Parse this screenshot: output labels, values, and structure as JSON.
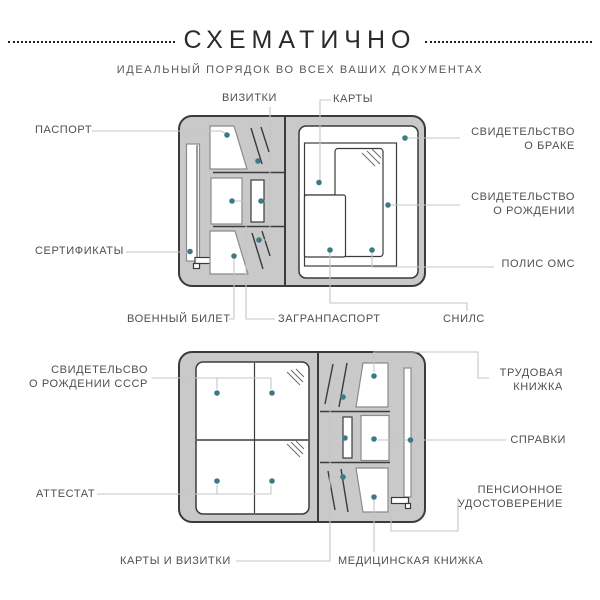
{
  "header": {
    "title": "СХЕМАТИЧНО",
    "subtitle": "ИДЕАЛЬНЫЙ ПОРЯДОК ВО ВСЕХ ВАШИХ ДОКУМЕНТАХ"
  },
  "colors": {
    "marker": "#3e7a86",
    "body_gray": "#c9c9c9",
    "outline_dark": "#3b3b3b",
    "leader_line": "#c5c5c5",
    "label_text": "#4f4f4f",
    "title_text": "#2a2a2a",
    "subtitle_text": "#585858"
  },
  "top_diagram": {
    "labels": {
      "passport": {
        "text": "ПАСПОРТ"
      },
      "business_cards": {
        "text": "ВИЗИТКИ"
      },
      "cards": {
        "text": "КАРТЫ"
      },
      "marriage_certificate": {
        "line1": "СВИДЕТЕЛЬСТВО",
        "line2": "О БРАКЕ"
      },
      "birth_certificate": {
        "line1": "СВИДЕТЕЛЬСТВО",
        "line2": "О РОЖДЕНИИ"
      },
      "oms_policy": {
        "text": "ПОЛИС ОМС"
      },
      "certificates": {
        "text": "СЕРТИФИКАТЫ"
      },
      "military_id": {
        "text": "ВОЕННЫЙ БИЛЕТ"
      },
      "international_passport": {
        "text": "ЗАГРАНПАСПОРТ"
      },
      "snils": {
        "text": "СНИЛС"
      }
    }
  },
  "bottom_diagram": {
    "labels": {
      "ussr_birth_certificate": {
        "line1": "СВИДЕТЕЛЬСВО",
        "line2": "О РОЖДЕНИИ СССР"
      },
      "attestat": {
        "text": "АТТЕСТАТ"
      },
      "work_record_book": {
        "line1": "ТРУДОВАЯ",
        "line2": "КНИЖКА"
      },
      "references": {
        "text": "СПРАВКИ"
      },
      "pension_certificate": {
        "line1": "ПЕНСИОННОЕ",
        "line2": "УДОСТОВЕРЕНИЕ"
      },
      "cards_and_business_cards": {
        "text": "КАРТЫ И ВИЗИТКИ"
      },
      "medical_book": {
        "text": "МЕДИЦИНСКАЯ КНИЖКА"
      }
    }
  }
}
